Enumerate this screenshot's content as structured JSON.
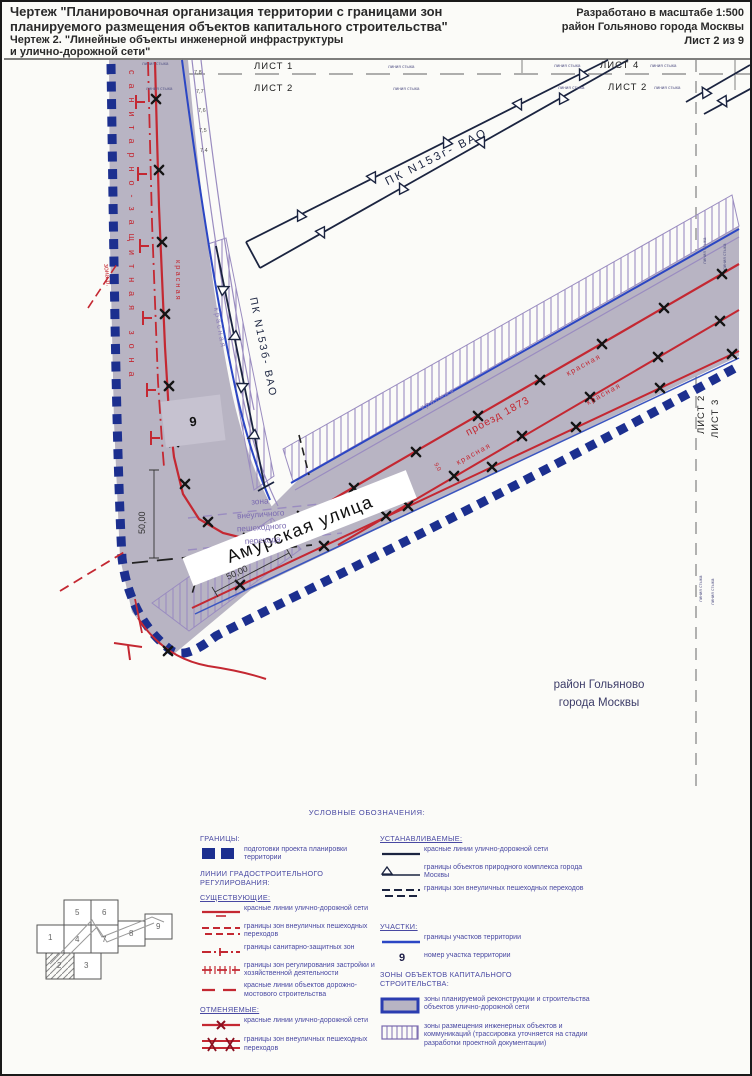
{
  "header": {
    "title1": "Чертеж \"Планировочная организация территории с границами зон",
    "title2": "планируемого размещения объектов капитального строительства\"",
    "subtitle1": "Чертеж 2. \"Линейные объекты инженерной инфраструктуры",
    "subtitle2": "и улично-дорожной сети\"",
    "right1": "Разработано в масштабе 1:500",
    "right2": "район Гольяново города Москвы",
    "right3": "Лист 2 из 9"
  },
  "sheets": {
    "s1": "ЛИСТ 1",
    "s2": "ЛИСТ 2",
    "s4": "ЛИСТ 4",
    "s3": "ЛИСТ 3",
    "junction": "линия стыка"
  },
  "map": {
    "pk_upper": "ПК N153г- ВАО",
    "pk_lower": "ПК N153б- ВАО",
    "sanitary": "санитарно-защитная зона",
    "krasnaya": "красная",
    "zona_r": "зона р.",
    "amur": "Амурская улица",
    "proezd": "проезд 1873",
    "ped1": "зона",
    "ped2": "внеуличного",
    "ped3": "пешеходного",
    "ped4": "перехода",
    "dim50": "50,00",
    "dim90": "9,0",
    "parcel": "9",
    "district1": "район Гольяново",
    "district2": "города Москвы",
    "curve_labels": [
      "7,8",
      "7,7",
      "7,6",
      "7,5",
      "7,4"
    ]
  },
  "legend": {
    "title": "УСЛОВНЫЕ ОБОЗНАЧЕНИЯ:",
    "granicy": "ГРАНИЦЫ:",
    "granicy_item": "подготовки проекта планировки территории",
    "lines_header": "ЛИНИИ ГРАДОСТРОИТЕЛЬНОГО РЕГУЛИРОВАНИЯ:",
    "existing": "СУЩЕСТВУЮЩИЕ:",
    "existing_items": [
      "красные линии улично-дорожной сети",
      "границы зон внеуличных пешеходных переходов",
      "границы санитарно-защитных зон",
      "границы зон регулирования застройки и хозяйственной деятельности",
      "красные линии объектов дорожно-мостового строительства"
    ],
    "cancelled": "ОТМЕНЯЕМЫЕ:",
    "cancelled_items": [
      "красные линии улично-дорожной сети",
      "границы зон внеуличных пешеходных переходов"
    ],
    "established": "УСТАНАВЛИВАЕМЫЕ:",
    "established_items": [
      "красные линии улично-дорожной сети",
      "границы объектов природного комплекса города Москвы",
      "границы зон внеуличных пешеходных переходов"
    ],
    "plots": "УЧАСТКИ:",
    "plots_items": [
      "границы участков территории",
      "номер участка территории"
    ],
    "plot_number": "9",
    "zones_header": "ЗОНЫ ОБЪЕКТОВ КАПИТАЛЬНОГО СТРОИТЕЛЬСТВА:",
    "zones_items": [
      "зоны планируемой реконструкции и строительства объектов улично-дорожной сети",
      "зоны размещения инженерных объектов и коммуникаций (трассировка уточняется на стадии разработки проектной документации)"
    ]
  },
  "keymap": {
    "cells": [
      "1",
      "2",
      "3",
      "4",
      "5",
      "6",
      "7",
      "8",
      "9"
    ]
  },
  "colors": {
    "red_line": "#c42832",
    "navy_boundary": "#1c2f8f",
    "plot_blue": "#2b46c4",
    "purple_line": "#9a8cc0",
    "zone_gray": "#b8b4c3",
    "legend_text": "#4848a2"
  }
}
